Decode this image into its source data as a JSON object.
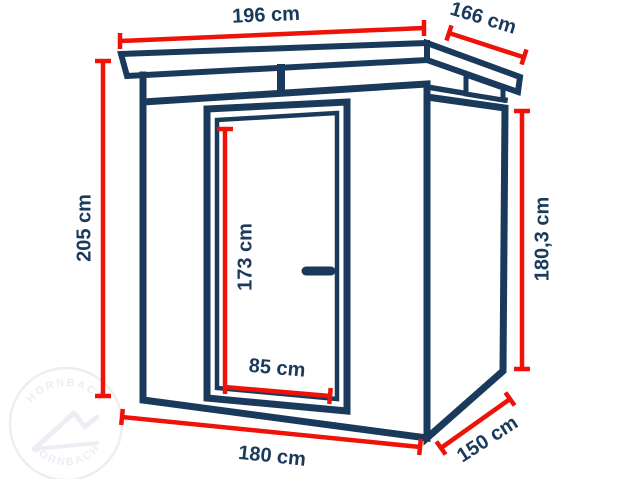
{
  "diagram_title": "shed-dimension-diagram",
  "dims": {
    "roof_width": "196 cm",
    "roof_depth": "166 cm",
    "height_total": "205 cm",
    "wall_height": "180,3 cm",
    "door_height": "173 cm",
    "door_width": "85 cm",
    "base_width": "180 cm",
    "base_depth": "150 cm"
  },
  "watermark": {
    "text": "HORNBACH"
  },
  "colors": {
    "outline": "#1a3a5c",
    "dimension_red": "#ee1208",
    "label_text": "#1a3a5c",
    "watermark": "#eceef3",
    "background": "#ffffff"
  }
}
